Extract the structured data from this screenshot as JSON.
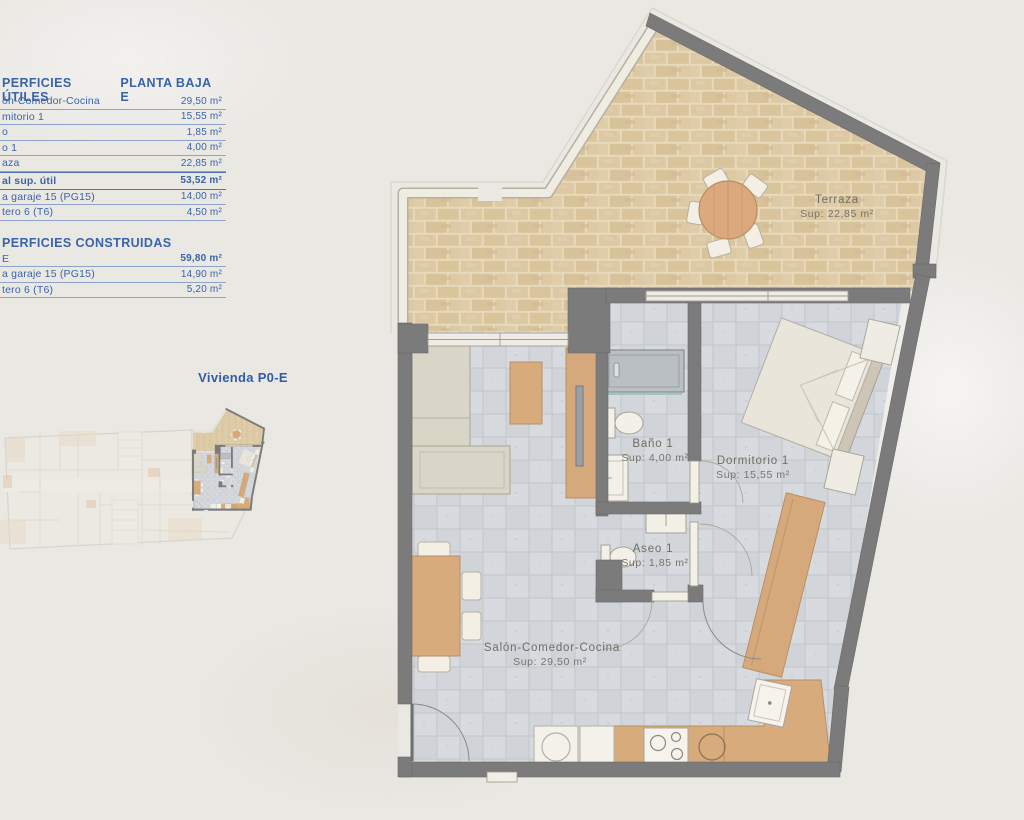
{
  "panel": {
    "title_left": "PERFICIES ÚTILES",
    "title_right": "PLANTA BAJA E",
    "useful_rows": [
      {
        "label": "ón-Comedor-Cocina",
        "value": "29,50 m²"
      },
      {
        "label": "mitorio 1",
        "value": "15,55 m²"
      },
      {
        "label": "o",
        "value": "1,85 m²"
      },
      {
        "label": "o 1",
        "value": "4,00 m²"
      },
      {
        "label": "aza",
        "value": "22,85 m²"
      }
    ],
    "total_row": {
      "label": "al sup. útil",
      "value": "53,52 m²"
    },
    "annex_rows": [
      {
        "label": "a garaje 15 (PG15)",
        "value": "14,00 m²"
      },
      {
        "label": "tero 6 (T6)",
        "value": "4,50 m²"
      }
    ],
    "built_title": "PERFICIES CONSTRUIDAS",
    "built_rows": [
      {
        "label": "E",
        "value": "59,80 m²"
      },
      {
        "label": "a garaje 15 (PG15)",
        "value": "14,90 m²"
      },
      {
        "label": "tero 6 (T6)",
        "value": "5,20 m²"
      }
    ],
    "key_plan_label": "Vivienda P0-E"
  },
  "plan": {
    "rooms": {
      "terraza": {
        "name": "Terraza",
        "sup": "Sup: 22,85 m²"
      },
      "bano": {
        "name": "Baño 1",
        "sup": "Sup: 4,00 m²"
      },
      "dormitorio": {
        "name": "Dormitorio 1",
        "sup": "Sup: 15,55 m²"
      },
      "aseo": {
        "name": "Aseo 1",
        "sup": "Sup: 1,85 m²"
      },
      "salon": {
        "name": "Salón-Comedor-Cocina",
        "sup": "Sup: 29,50 m²"
      }
    }
  },
  "colors": {
    "accent_blue": "#3a63a8",
    "wall_gray": "#7b7b7b",
    "terrace_brick": "#dcc8a4",
    "floor_tile": "#d7dadd",
    "wood": "#d8ab7d",
    "background": "#eae8e3"
  }
}
